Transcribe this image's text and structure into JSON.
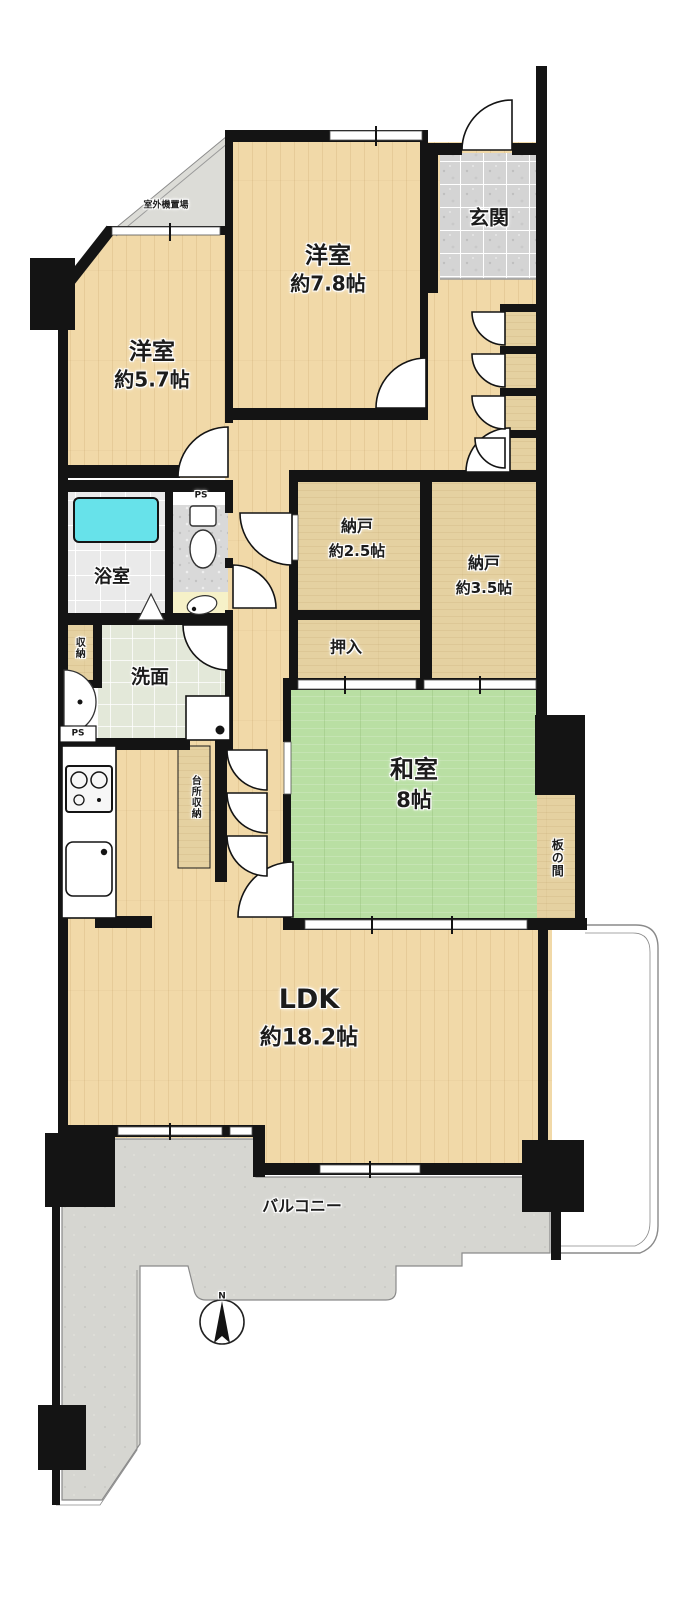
{
  "floorplan": {
    "rooms": {
      "western_room_1": {
        "label": "洋室",
        "size": "約7.8帖"
      },
      "western_room_2": {
        "label": "洋室",
        "size": "約5.7帖"
      },
      "entrance": {
        "label": "玄関"
      },
      "outdoor_unit_area": {
        "label": "室外機置場"
      },
      "storage_room_1": {
        "label": "納戸",
        "size": "約2.5帖"
      },
      "storage_room_2": {
        "label": "納戸",
        "size": "約3.5帖"
      },
      "oshiire_closet": {
        "label": "押入"
      },
      "japanese_room": {
        "label": "和室",
        "size": "8帖"
      },
      "wooden_floor_area": {
        "label": "板の間"
      },
      "ldk": {
        "label": "LDK",
        "size": "約18.2帖"
      },
      "balcony": {
        "label": "バルコニー"
      },
      "bathroom": {
        "label": "浴室"
      },
      "washroom": {
        "label": "洗面"
      },
      "small_storage": {
        "label": "収納"
      },
      "kitchen_storage": {
        "label": "台所収納"
      },
      "pipe_space_toilet": {
        "label": "PS"
      },
      "pipe_space_kitchen": {
        "label": "PS"
      }
    },
    "compass": {
      "north_label": "N"
    },
    "colors": {
      "wall": "#141414",
      "wood_floor": "#f1d9a8",
      "tatami": "#b9dfa3",
      "storage_tan": "#e5d1a1",
      "balcony_gray": "#d6d6d1",
      "entrance_tile": "#d6d6d6",
      "bathtub": "#67e2ea"
    }
  }
}
